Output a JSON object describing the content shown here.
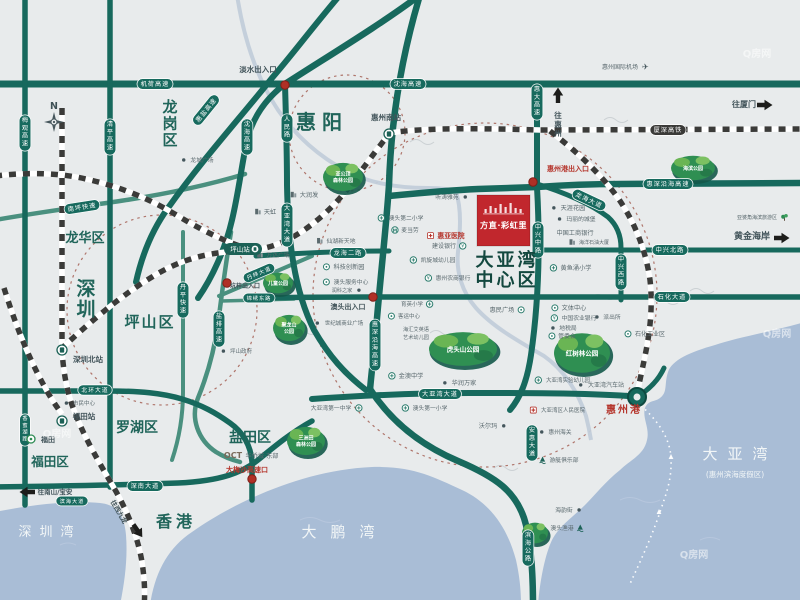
{
  "project": {
    "name": "方直·彩虹里",
    "marker_color": "#c1272d"
  },
  "compass": {
    "label": "N"
  },
  "watermark": {
    "text": "Q房网",
    "spots": [
      [
        757,
        57
      ],
      [
        777,
        337
      ],
      [
        694,
        558
      ],
      [
        57,
        437
      ]
    ]
  },
  "colors": {
    "road": "#17695d",
    "road_light": "#4a907f",
    "pill": "#176a5e",
    "rail_pill": "#3a3a38",
    "red": "#b5352c",
    "district": "#20655a",
    "center_district": "#13483f",
    "sea_text": "#f2f6f7",
    "grey": "#5a696e",
    "dark": "#42545a",
    "water": "#a9bdd6",
    "park": "#2f8f52",
    "icon": "#2c7c6d",
    "oct": "#7a6a5a"
  },
  "regions": [
    {
      "t": "惠阳",
      "x": 322,
      "y": 129,
      "s": 20,
      "c": "district",
      "ls": 6,
      "b": 1
    },
    {
      "t": "龙岗区",
      "x": 170,
      "y": 100,
      "s": 15,
      "c": "district",
      "v": 1,
      "b": 1
    },
    {
      "t": "深圳",
      "x": 86,
      "y": 280,
      "s": 19,
      "c": "district",
      "v": 1,
      "b": 1
    },
    {
      "t": "坪山区",
      "x": 150,
      "y": 327,
      "s": 15,
      "c": "district",
      "b": 1,
      "ls": 2
    },
    {
      "t": "龙华区",
      "x": 85,
      "y": 242,
      "s": 13,
      "c": "district",
      "b": 1
    },
    {
      "t": "罗湖区",
      "x": 137,
      "y": 432,
      "s": 14,
      "c": "district",
      "b": 1
    },
    {
      "t": "福田区",
      "x": 50,
      "y": 466,
      "s": 12.5,
      "c": "district",
      "b": 1
    },
    {
      "t": "盐田区",
      "x": 250,
      "y": 442,
      "s": 14,
      "c": "district",
      "b": 1
    },
    {
      "t": "香港",
      "x": 176,
      "y": 527,
      "s": 16,
      "c": "district",
      "b": 1,
      "ls": 4
    },
    {
      "t": "大亚湾",
      "x": 507,
      "y": 266,
      "s": 18,
      "c": "center_district",
      "b": 1,
      "ls": 3
    },
    {
      "t": "中心区",
      "x": 507,
      "y": 286,
      "s": 18,
      "c": "center_district",
      "b": 1,
      "ls": 3
    },
    {
      "t": "深圳湾",
      "x": 50,
      "y": 536,
      "s": 13,
      "c": "sea_text",
      "ls": 8
    },
    {
      "t": "大鹏湾",
      "x": 345,
      "y": 537,
      "s": 15,
      "c": "sea_text",
      "ls": 14
    },
    {
      "t": "大亚湾",
      "x": 740,
      "y": 459,
      "s": 15,
      "c": "sea_text",
      "ls": 10
    },
    {
      "t": "(惠州滨海度假区)",
      "x": 735,
      "y": 477,
      "s": 7.5,
      "c": "sea_text"
    }
  ],
  "road_pills": [
    {
      "t": "机荷高速",
      "x": 155,
      "y": 84
    },
    {
      "t": "沈海高速",
      "x": 408,
      "y": 84
    },
    {
      "t": "沈海高速",
      "x": 247,
      "y": 137,
      "v": 1
    },
    {
      "t": "惠盐高速",
      "x": 206,
      "y": 110,
      "r": -51
    },
    {
      "t": "清平高速",
      "x": 110,
      "y": 137,
      "v": 1
    },
    {
      "t": "梅观高速",
      "x": 25,
      "y": 133,
      "v": 1
    },
    {
      "t": "人民路",
      "x": 287,
      "y": 128,
      "v": 1
    },
    {
      "t": "大亚湾大道",
      "x": 287,
      "y": 225,
      "v": 1
    },
    {
      "t": "惠大高速",
      "x": 537,
      "y": 102,
      "v": 1
    },
    {
      "t": "厦深高铁",
      "x": 668,
      "y": 130,
      "rail": 1
    },
    {
      "t": "惠深沿海高速",
      "x": 668,
      "y": 184
    },
    {
      "t": "中兴北路",
      "x": 670,
      "y": 250
    },
    {
      "t": "石化大道",
      "x": 672,
      "y": 297
    },
    {
      "t": "中兴中路",
      "x": 538,
      "y": 240,
      "v": 1
    },
    {
      "t": "中兴西路",
      "x": 621,
      "y": 272,
      "v": 1
    },
    {
      "t": "龙海大道",
      "x": 589,
      "y": 200,
      "r": 25
    },
    {
      "t": "龙海二路",
      "x": 348,
      "y": 253
    },
    {
      "t": "惠深沿海高速",
      "x": 375,
      "y": 345,
      "v": 1
    },
    {
      "t": "大亚湾大道",
      "x": 440,
      "y": 394
    },
    {
      "t": "安惠大道",
      "x": 532,
      "y": 443,
      "v": 1
    },
    {
      "t": "滨海公路",
      "x": 528,
      "y": 548,
      "v": 1
    },
    {
      "t": "南坪快速",
      "x": 82,
      "y": 207,
      "r": -9
    },
    {
      "t": "丹平快速",
      "x": 183,
      "y": 300,
      "v": 1
    },
    {
      "t": "盐排高速",
      "x": 219,
      "y": 329,
      "v": 1
    },
    {
      "t": "北环大道",
      "x": 95,
      "y": 390,
      "s": 5.8
    },
    {
      "t": "深南大道",
      "x": 145,
      "y": 486
    },
    {
      "t": "滨海大道",
      "x": 72,
      "y": 501,
      "s": 5.2
    },
    {
      "t": "香蜜湖路",
      "x": 25,
      "y": 430,
      "v": 1,
      "s": 5.2
    },
    {
      "t": "丹梓大道",
      "x": 259,
      "y": 273,
      "r": -23,
      "s": 5.5
    },
    {
      "t": "锦绣东路",
      "x": 259,
      "y": 298,
      "s": 5.2
    }
  ],
  "pois": [
    {
      "t": "龙城广场",
      "x": 202,
      "y": 162,
      "i": "dt",
      "s": 5.8
    },
    {
      "t": "大润发",
      "x": 309,
      "y": 197,
      "i": "bd"
    },
    {
      "t": "天虹",
      "x": 270,
      "y": 214,
      "i": "bd"
    },
    {
      "t": "仙湖新天地",
      "x": 341,
      "y": 243,
      "i": "bd",
      "s": 5.8
    },
    {
      "t": "万达广场",
      "x": 278,
      "y": 257,
      "i": "bd",
      "s": 5.8
    },
    {
      "t": "科技创新园",
      "x": 349,
      "y": 269,
      "i": "rg"
    },
    {
      "t": "澳头服务中心",
      "x": 351,
      "y": 284,
      "i": "rg",
      "s": 5.8
    },
    {
      "t": "润科之家",
      "x": 342,
      "y": 292,
      "i": "dt",
      "sd": "r",
      "s": 5.2
    },
    {
      "t": "澳头出入口",
      "x": 348,
      "y": 309,
      "c": "dark",
      "s": 7,
      "b": 1
    },
    {
      "t": "世纪城商业广场",
      "x": 344,
      "y": 325,
      "i": "dt",
      "s": 5.5
    },
    {
      "t": "坑梓出入口",
      "x": 245,
      "y": 288,
      "c": "dark",
      "s": 6,
      "b": 1
    },
    {
      "t": "坪山政府",
      "x": 241,
      "y": 353,
      "i": "dt",
      "s": 5.5
    },
    {
      "t": "听涛雅苑",
      "x": 447,
      "y": 199,
      "i": "dt",
      "sd": "r",
      "s": 5.8
    },
    {
      "t": "澳头第二小学",
      "x": 406,
      "y": 220,
      "i": "sc",
      "s": 5.8
    },
    {
      "t": "麦当劳",
      "x": 410,
      "y": 232,
      "i": "mc",
      "s": 5.8
    },
    {
      "t": "惠亚医院",
      "x": 451,
      "y": 238,
      "i": "hp",
      "c": "red",
      "s": 6.8,
      "b": 1
    },
    {
      "t": "建设银行",
      "x": 444,
      "y": 248,
      "i": "bk",
      "sd": "r",
      "s": 6
    },
    {
      "t": "凯旋城幼儿园",
      "x": 438,
      "y": 262,
      "i": "sc",
      "s": 5.8
    },
    {
      "t": "惠州农商银行",
      "x": 453,
      "y": 280,
      "i": "bk",
      "s": 5.8
    },
    {
      "t": "育英小学",
      "x": 412,
      "y": 306,
      "i": "sc",
      "sd": "r",
      "s": 5.5
    },
    {
      "t": "客运中心",
      "x": 409,
      "y": 318,
      "i": "rg",
      "s": 5.5
    },
    {
      "t": "海汇艾英语",
      "x": 416,
      "y": 331,
      "s": 5.2
    },
    {
      "t": "艺术幼儿园",
      "x": 416,
      "y": 339,
      "s": 5.2
    },
    {
      "t": "金澳中学",
      "x": 411,
      "y": 378,
      "i": "sc"
    },
    {
      "t": "华润万家",
      "x": 464,
      "y": 385,
      "i": "dt"
    },
    {
      "t": "惠民广场",
      "x": 502,
      "y": 312,
      "i": "rg",
      "sd": "r"
    },
    {
      "t": "大亚湾第一中学",
      "x": 331,
      "y": 410,
      "i": "sc",
      "sd": "r",
      "s": 5.8
    },
    {
      "t": "澳头第一小学",
      "x": 430,
      "y": 410,
      "i": "sc",
      "s": 5.8
    },
    {
      "t": "沃尔玛",
      "x": 488,
      "y": 428,
      "i": "dt",
      "sd": "r"
    },
    {
      "t": "市民中心",
      "x": 84,
      "y": 405,
      "i": "dt",
      "s": 5.5
    },
    {
      "t": "天涯花园",
      "x": 573,
      "y": 210,
      "i": "dt"
    },
    {
      "t": "玛丽的城堡",
      "x": 581,
      "y": 221,
      "i": "dt",
      "s": 5.8
    },
    {
      "t": "中国工商银行",
      "x": 575,
      "y": 235,
      "s": 6.2
    },
    {
      "t": "海洋石油大厦",
      "x": 594,
      "y": 244,
      "i": "bd",
      "s": 5
    },
    {
      "t": "黄鱼涌小学",
      "x": 576,
      "y": 270,
      "i": "sc"
    },
    {
      "t": "文体中心",
      "x": 574,
      "y": 310,
      "i": "rg"
    },
    {
      "t": "中国农业银行",
      "x": 579,
      "y": 320,
      "i": "bk",
      "s": 5.8
    },
    {
      "t": "地税局",
      "x": 568,
      "y": 330,
      "i": "dt",
      "s": 5.8
    },
    {
      "t": "管委会",
      "x": 567,
      "y": 338,
      "i": "rg",
      "s": 5.8
    },
    {
      "t": "派出所",
      "x": 612,
      "y": 319,
      "i": "dt",
      "s": 5.8
    },
    {
      "t": "石化工业区",
      "x": 650,
      "y": 336,
      "i": "rg",
      "s": 6
    },
    {
      "t": "大亚湾实验幼儿园",
      "x": 568,
      "y": 382,
      "i": "sc",
      "s": 5.5
    },
    {
      "t": "大亚湾汽车站",
      "x": 606,
      "y": 387,
      "i": "dt",
      "s": 6
    },
    {
      "t": "大亚湾区人民医院",
      "x": 563,
      "y": 412,
      "i": "hp",
      "s": 5.5
    },
    {
      "t": "惠州海关",
      "x": 560,
      "y": 434,
      "i": "dt",
      "s": 5.8
    },
    {
      "t": "游艇俱乐部",
      "x": 564,
      "y": 462,
      "i": "an",
      "s": 5.8
    },
    {
      "t": "海韵街",
      "x": 564,
      "y": 512,
      "i": "dt",
      "sd": "r",
      "s": 5.8
    },
    {
      "t": "澳头渔港",
      "x": 562,
      "y": 530,
      "i": "an",
      "sd": "r",
      "s": 5.8
    },
    {
      "t": "惠州国际机场",
      "x": 620,
      "y": 69,
      "i": "pl",
      "sd": "r",
      "s": 6
    },
    {
      "t": "亚婆角海滨旅游区",
      "x": 757,
      "y": 219,
      "i": "tr",
      "sd": "r",
      "s": 5
    },
    {
      "t": "淡水出入口",
      "x": 258,
      "y": 72,
      "c": "dark",
      "s": 7.5,
      "b": 1
    },
    {
      "t": "惠州港出入口",
      "x": 568,
      "y": 171,
      "c": "red",
      "s": 7,
      "b": 1
    },
    {
      "t": "大梅沙高速口",
      "x": 247,
      "y": 472,
      "c": "red",
      "s": 7,
      "b": 1
    },
    {
      "t": "惠州港",
      "x": 624,
      "y": 413,
      "c": "red",
      "s": 10,
      "b": 1,
      "ls": 2
    },
    {
      "t": "黄金海岸",
      "x": 752,
      "y": 239,
      "c": "dark",
      "s": 9,
      "b": 1
    },
    {
      "t": "往惠州",
      "x": 558,
      "y": 112,
      "c": "dark",
      "s": 7.5,
      "b": 1,
      "v": 1
    },
    {
      "t": "往厦门",
      "x": 744,
      "y": 107,
      "c": "dark",
      "s": 8,
      "b": 1
    },
    {
      "t": "往南山/宝安",
      "x": 55,
      "y": 494,
      "c": "dark",
      "s": 6.5,
      "b": 1
    },
    {
      "t": "往西九龙",
      "x": 117,
      "y": 513,
      "c": "dark",
      "s": 6.5,
      "b": 1,
      "r": 60
    },
    {
      "t": "OCT",
      "x": 233,
      "y": 458,
      "c": "oct",
      "s": 8,
      "b": 1
    },
    {
      "t": "华侨城·东部",
      "x": 262,
      "y": 458,
      "c": "grey",
      "s": 6.2
    }
  ],
  "stations": [
    {
      "t": "深圳北站",
      "x": 62,
      "y": 350,
      "lx": 88,
      "ly": 362
    },
    {
      "t": "福田站",
      "x": 62,
      "y": 421,
      "lx": 84,
      "ly": 419
    },
    {
      "t": "惠州南站",
      "x": 389,
      "y": 134,
      "lx": 386,
      "ly": 120
    },
    {
      "t": "坪山站",
      "x": 243,
      "y": 249,
      "pill": 1
    },
    {
      "t": "福田",
      "x": 31,
      "y": 439,
      "lx": 48,
      "ly": 442,
      "metro": 1
    }
  ],
  "parks": [
    {
      "lines": [
        "亚公顶",
        "森林公园"
      ],
      "x": 343,
      "y": 177,
      "w": 40,
      "h": 30
    },
    {
      "lines": [
        "海滨公园"
      ],
      "x": 693,
      "y": 168,
      "w": 44,
      "h": 26
    },
    {
      "lines": [
        "儿童公园"
      ],
      "x": 278,
      "y": 283,
      "w": 30,
      "h": 22
    },
    {
      "lines": [
        "聚龙山",
        "公园"
      ],
      "x": 289,
      "y": 328,
      "w": 32,
      "h": 28
    },
    {
      "lines": [
        "虎头山公园"
      ],
      "x": 463,
      "y": 349,
      "w": 68,
      "h": 36
    },
    {
      "lines": [
        "红树林公园"
      ],
      "x": 582,
      "y": 353,
      "w": 56,
      "h": 42
    },
    {
      "lines": [
        "三洲田",
        "森林公园"
      ],
      "x": 306,
      "y": 441,
      "w": 38,
      "h": 30
    },
    {
      "lines": [],
      "x": 535,
      "y": 533,
      "w": 26,
      "h": 22
    }
  ],
  "exit_dots": [
    [
      285,
      85
    ],
    [
      533,
      182
    ],
    [
      373,
      297
    ],
    [
      252,
      479
    ],
    [
      227,
      283
    ]
  ],
  "port_node": [
    637,
    397
  ],
  "boats": [
    [
      671,
      457
    ],
    [
      659,
      512
    ]
  ],
  "arrows": [
    {
      "x": 558,
      "y": 95,
      "r": 0
    },
    {
      "x": 765,
      "y": 105,
      "r": 90
    },
    {
      "x": 782,
      "y": 238,
      "r": 90
    },
    {
      "x": 27,
      "y": 492,
      "r": -90
    },
    {
      "x": 138,
      "y": 531,
      "r": 145
    }
  ]
}
